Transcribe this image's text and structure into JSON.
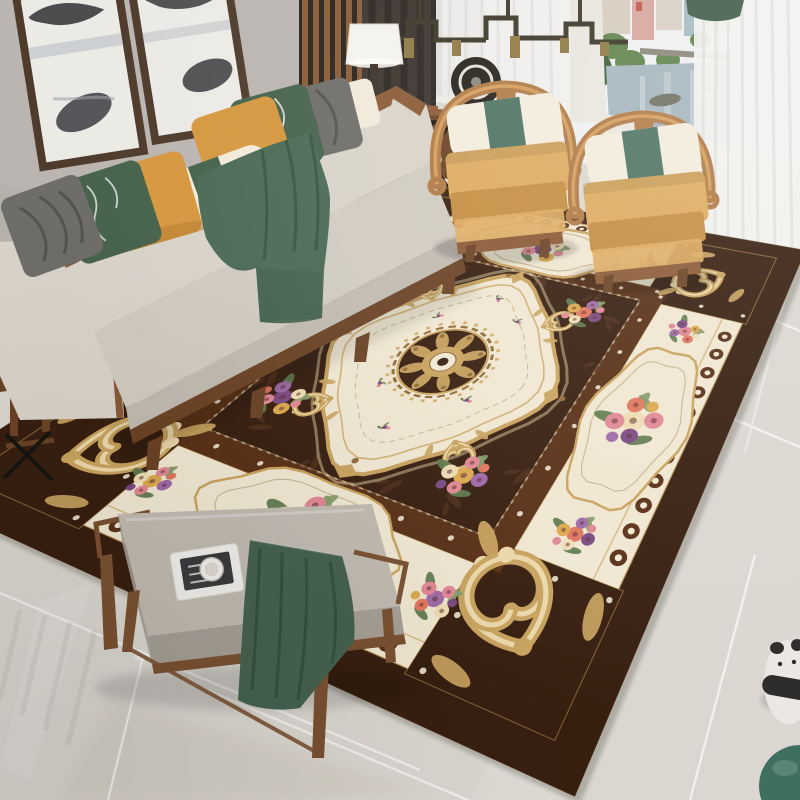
{
  "colors": {
    "floor": "#dbd7d0",
    "floorWarm": "#cfc8bc",
    "grout": "#f7f6f2",
    "sparkle": "#ffffff",
    "wall": "#b7b1ac",
    "frameWood": "#4e3b2c",
    "art": "#eceae5",
    "ink": "#35363a",
    "inkSoft": "#9aa2ac",
    "slatWood": "#8a5a36",
    "slatGap": "#29211a",
    "curtainDark": "#3a332c",
    "curtainFold": "#27211c",
    "sheer": "#f2f1ee",
    "sheerFold": "#d9d7d3",
    "glassSky": "#edeff0",
    "building": "#d5cbbd",
    "buildingPink": "#d4a49b",
    "buildingBlue": "#a4b9c3",
    "buildingDark": "#8a8478",
    "tree": "#5d8148",
    "treeDark": "#3c5c33",
    "water": "#a3b5bc",
    "waterLight": "#c6d2d6",
    "rock": "#6e6e60",
    "brass": "#8d7840",
    "brassDark": "#3a3424",
    "sofaWood": "#8a5a36",
    "sofaWoodDark": "#6b4325",
    "cushion": "#d9d3c9",
    "cushionShade": "#b9b2a6",
    "seat": "#d1cbc0",
    "seatFront": "#c1bab0",
    "pillowGray": "#6e6d69",
    "pillowGrayDark": "#54534f",
    "pillowGreen": "#47634c",
    "greenPillowTop": "#3f5a46",
    "pillowMustard": "#d6973f",
    "pillowMustardDark": "#b37a2c",
    "pillowWhite": "#f1ead9",
    "throwGreen": "#4b6a55",
    "throwGreenDark": "#3a5544",
    "chairWood": "#b07a44",
    "chairWoodLight": "#d9a15f",
    "chairCushion": "#ddab5f",
    "chairCushionDark": "#c48e41",
    "chairPillow": "#f2ecdc",
    "chairBand": "#4e7362",
    "benchWood": "#7a5132",
    "benchCushionTop": "#c0bab0",
    "benchFront": "#a59f95",
    "runnerGreen": "#45624e",
    "runnerGreenDark": "#35503f",
    "tray": "#efeeea",
    "magazine": "#3b3b3d",
    "cup": "#f2f0ec",
    "sill": "#e9e5de",
    "lampShade": "#f4f2ed",
    "lampBase": "#3a3028",
    "disc": "#232019",
    "discRing": "#e3dfd7",
    "panda": "#ebe8e3",
    "pandaBlack": "#2c2b29",
    "stoolGreen": "#3e6f61",
    "rugField": "#371f10",
    "rugFieldLeaf": "#573420",
    "rugCream": "#f0e7d2",
    "rugCreamShade": "#e0d4b6",
    "rugGold": "#c9a35f",
    "rugGoldLight": "#ecd9ab",
    "rugGoldDark": "#916c38",
    "laceBrown": "#5a3117",
    "flowerPink": "#e08894",
    "flowerCoral": "#e0765d",
    "flowerPurple": "#7b4a82",
    "flowerViolet": "#a06aa8",
    "flowerGold": "#dca84e",
    "flowerCream": "#eedcb2",
    "leafGreen": "#879b6a",
    "leafDark": "#5f7a4f"
  },
  "rug": {
    "quad": [
      [
        390,
        178
      ],
      [
        806,
        250
      ],
      [
        575,
        797
      ],
      [
        -95,
        490
      ]
    ],
    "ease_u": [
      0.8,
      0.2
    ],
    "ease_v": [
      0.45,
      0.55
    ],
    "bands": {
      "lace1_outer": 0.055,
      "border_mid": 0.0925,
      "lace2_outer": 0.212,
      "lace2_inner": 0.252,
      "block_in": 0.048,
      "block_out": 0.25
    },
    "medallion": {
      "cu": 0.5,
      "cv": 0.5,
      "ru": 0.185,
      "rv": 0.21,
      "a4": 0.09,
      "a8": 0.025
    },
    "mandala": {
      "r_ring": 0.079,
      "r_disc": 0.072,
      "r_gold": 0.034,
      "r_cream": 0.021,
      "r_core": 0.009,
      "petals": 8,
      "petal_r": 0.048
    },
    "corner_ornaments": [
      {
        "u": 0.135,
        "v": 0.135,
        "rot": 45,
        "s": 1.0
      },
      {
        "u": 0.865,
        "v": 0.135,
        "rot": 135,
        "s": 1.0
      },
      {
        "u": 0.865,
        "v": 0.865,
        "rot": 225,
        "s": 1.3
      },
      {
        "u": 0.135,
        "v": 0.865,
        "rot": 315,
        "s": 1.3
      }
    ],
    "cartouches": [
      {
        "u": 0.5,
        "v": 0.165,
        "ru": 0.155,
        "rv": 0.082
      },
      {
        "u": 0.5,
        "v": 0.835,
        "ru": 0.155,
        "rv": 0.082
      },
      {
        "u": 0.145,
        "v": 0.5,
        "ru": 0.082,
        "rv": 0.155
      },
      {
        "u": 0.855,
        "v": 0.5,
        "ru": 0.082,
        "rv": 0.155
      }
    ],
    "bouquets_large": [
      [
        0.5,
        0.17
      ],
      [
        0.5,
        0.825
      ],
      [
        0.15,
        0.5
      ],
      [
        0.85,
        0.5
      ]
    ],
    "bouquets_border": [
      [
        0.27,
        0.148
      ],
      [
        0.73,
        0.148
      ],
      [
        0.27,
        0.852
      ],
      [
        0.73,
        0.852
      ],
      [
        0.145,
        0.3
      ],
      [
        0.145,
        0.7
      ],
      [
        0.855,
        0.3
      ],
      [
        0.855,
        0.7
      ]
    ],
    "bouquets_field": [
      [
        0.335,
        0.335
      ],
      [
        0.665,
        0.315
      ],
      [
        0.315,
        0.655
      ],
      [
        0.66,
        0.675
      ]
    ],
    "sprigs": [
      [
        0.425,
        0.41
      ],
      [
        0.565,
        0.375
      ],
      [
        0.435,
        0.575
      ],
      [
        0.585,
        0.555
      ],
      [
        0.5,
        0.335
      ],
      [
        0.5,
        0.645
      ]
    ],
    "scroll_accents": [
      {
        "u": 0.385,
        "v": 0.375,
        "rot": 225,
        "s": 0.55
      },
      {
        "u": 0.615,
        "v": 0.37,
        "rot": 315,
        "s": 0.55
      },
      {
        "u": 0.615,
        "v": 0.63,
        "rot": 45,
        "s": 0.55
      },
      {
        "u": 0.385,
        "v": 0.63,
        "rot": 135,
        "s": 0.55
      }
    ],
    "tips": [
      [
        0.705,
        0.5,
        0
      ],
      [
        0.295,
        0.5,
        90
      ],
      [
        0.5,
        0.268,
        180
      ],
      [
        0.5,
        0.732,
        270
      ]
    ]
  }
}
